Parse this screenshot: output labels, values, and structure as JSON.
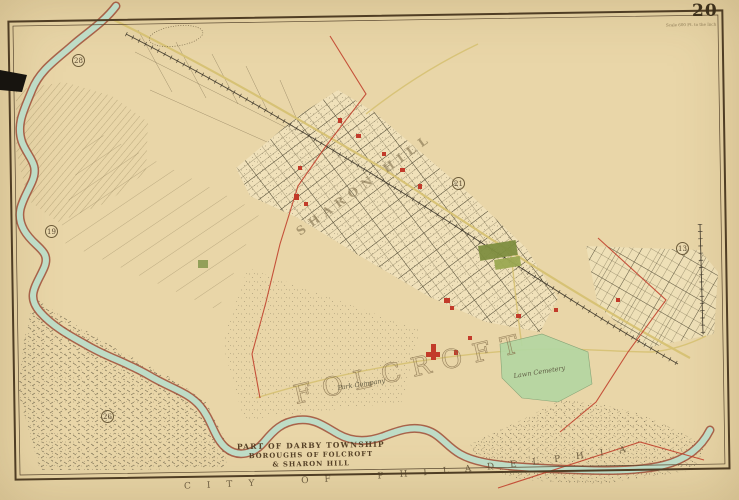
{
  "plate": {
    "number": "20",
    "corner_note": "Scale 600 Ft. to the Inch"
  },
  "title": {
    "line1": "PART OF DARBY TOWNSHIP",
    "line2": "BOROUGHS OF FOLCROFT",
    "line3": "& SHARON HILL"
  },
  "labels": {
    "city_boundary": "CITY OF PHILADELPHIA",
    "folcroft_large": "FOLCROFT",
    "sharon_hill": "SHARON HILL",
    "cemetery": "Lawn Cemetery",
    "park_company": "Park Company"
  },
  "plate_refs": [
    {
      "value": "28"
    },
    {
      "value": "19"
    },
    {
      "value": "21"
    },
    {
      "value": "13"
    },
    {
      "value": "26"
    }
  ],
  "colors": {
    "paper": "#e9d6a8",
    "border_ink": "#4f3d24",
    "water": "#bedcc6",
    "creek_bank": "#9e4f39",
    "boundary_red": "#c1432d",
    "road_yellow": "#d6c172",
    "park_green": "#7d8d3f",
    "cemetery_green": "#b4d7a2",
    "text_ink": "#554026"
  }
}
